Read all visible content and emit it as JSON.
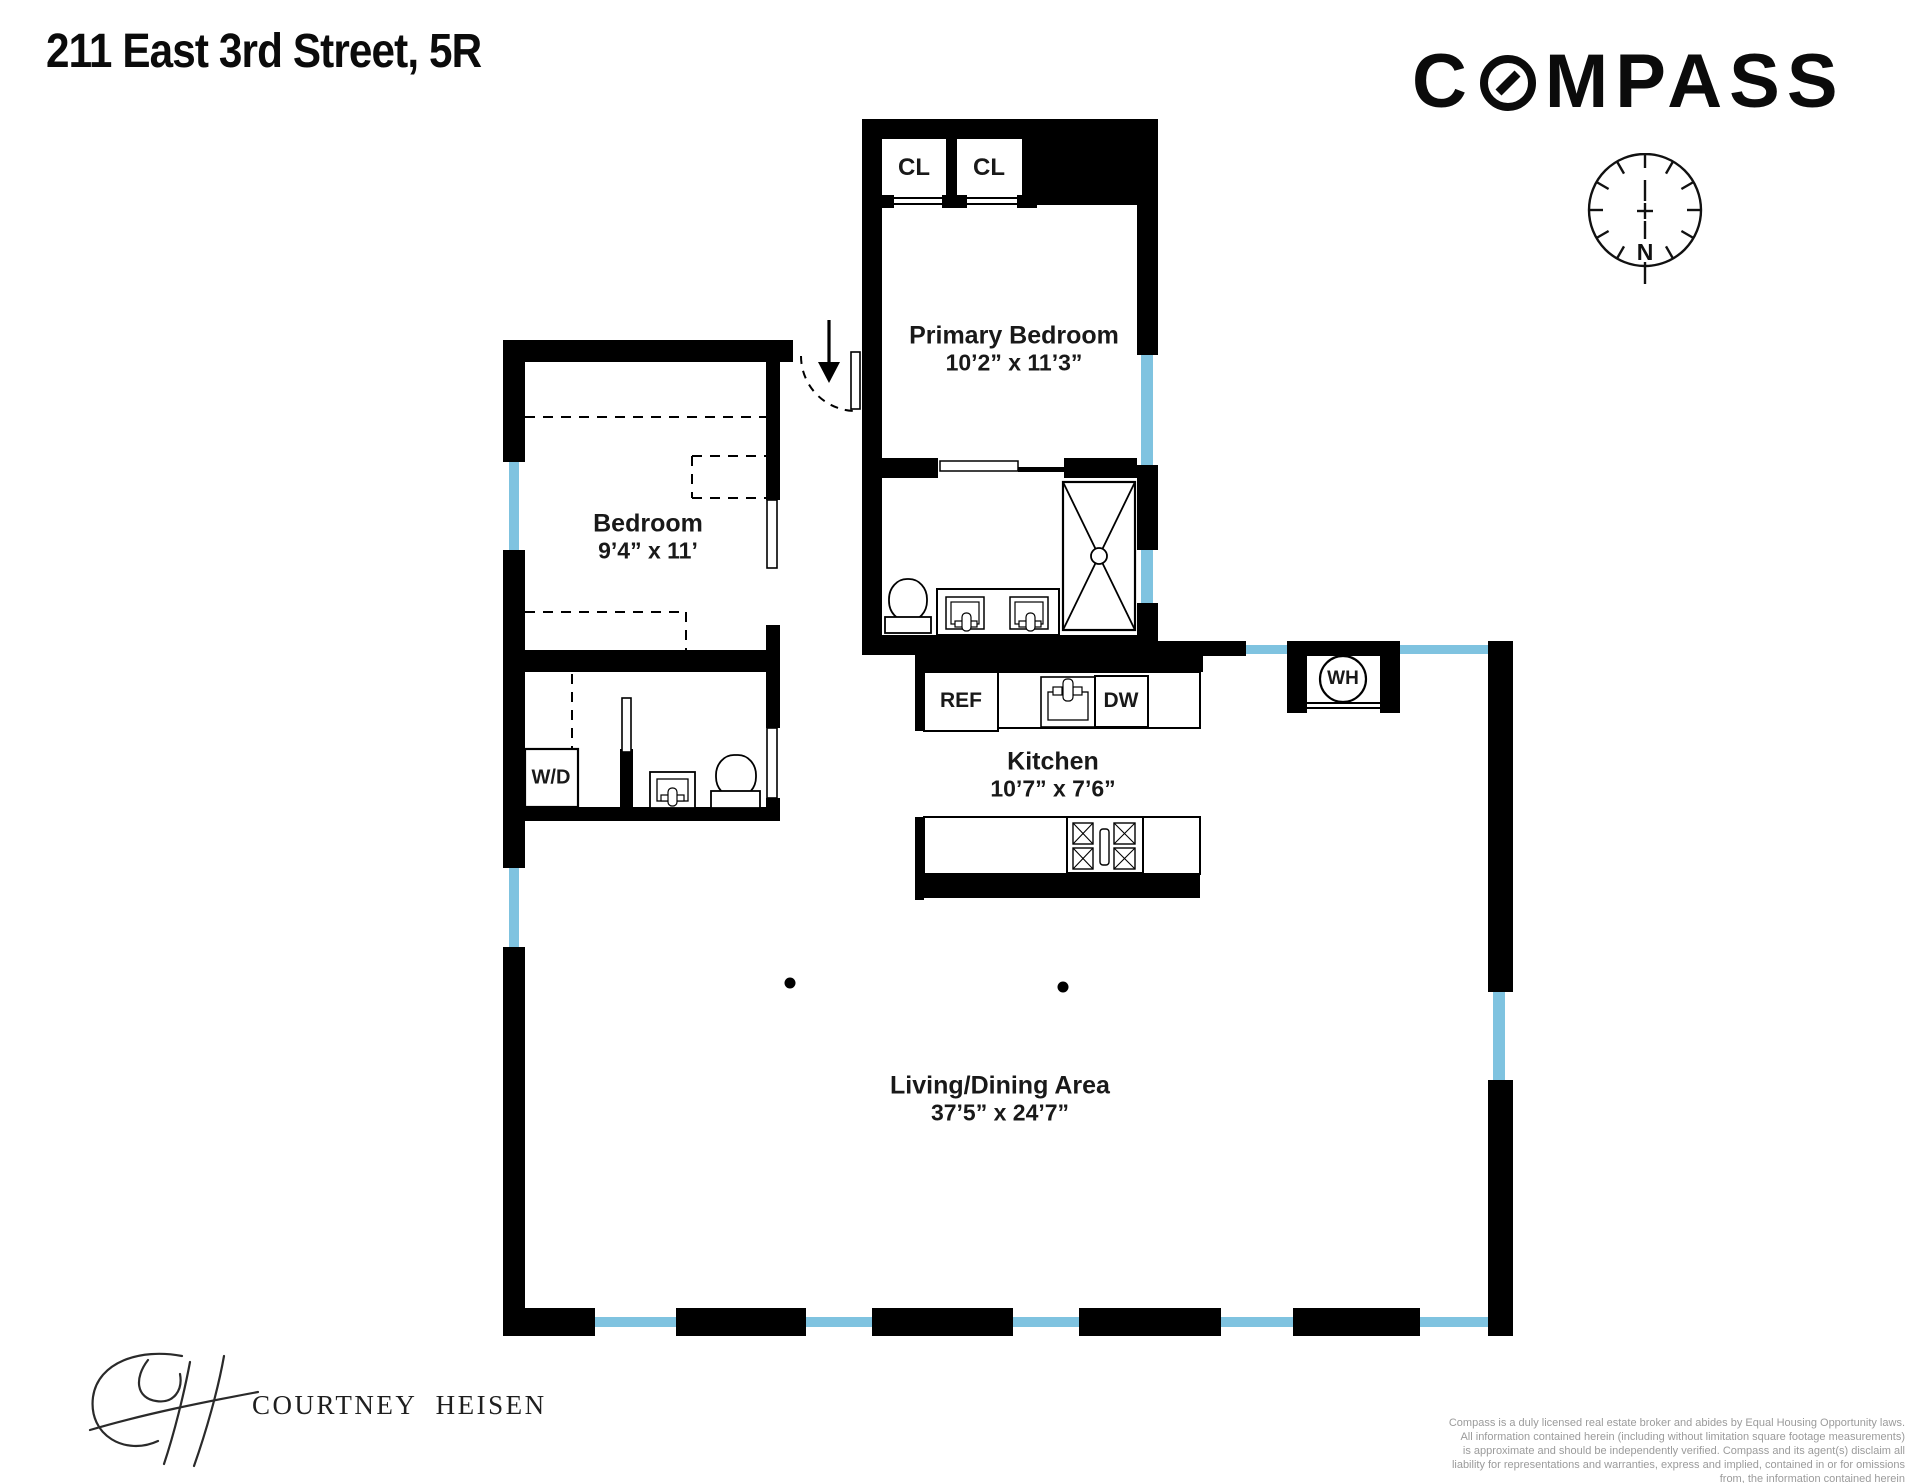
{
  "header": {
    "title": "211 East 3rd Street, 5R"
  },
  "brand": {
    "logo_prefix": "C",
    "logo_suffix": "MPASS",
    "logo_full": "COMPASS"
  },
  "compass_rose": {
    "north_label": "N"
  },
  "floorplan": {
    "primary_bedroom": {
      "label": "Primary Bedroom",
      "dims": "10’2” x 11’3”"
    },
    "bedroom": {
      "label": "Bedroom",
      "dims": "9’4” x 11’"
    },
    "kitchen": {
      "label": "Kitchen",
      "dims": "10’7” x 7’6”"
    },
    "living_dining": {
      "label": "Living/Dining Area",
      "dims": "37’5” x 24’7”"
    },
    "closet_1": {
      "label": "CL"
    },
    "closet_2": {
      "label": "CL"
    },
    "refrigerator": {
      "label": "REF"
    },
    "dishwasher": {
      "label": "DW"
    },
    "washer_dryer": {
      "label": "W/D"
    },
    "water_heater": {
      "label": "WH"
    }
  },
  "agent": {
    "name": "COURTNEY HEISEN"
  },
  "disclaimer": {
    "lines": [
      "Compass is a duly licensed real estate broker and abides by Equal Housing Opportunity laws.",
      "All information contained herein (including without limitation square footage measurements)",
      "is approximate and should be independently verified. Compass and its agent(s) disclaim all",
      "liability for representations and warranties, express and implied, contained in or for omissions",
      "from, the information contained herein"
    ]
  },
  "colors": {
    "wall": "#000000",
    "window": "#7FC3E0",
    "text": "#191919",
    "disclaimer_gray": "#9B9B9B"
  }
}
